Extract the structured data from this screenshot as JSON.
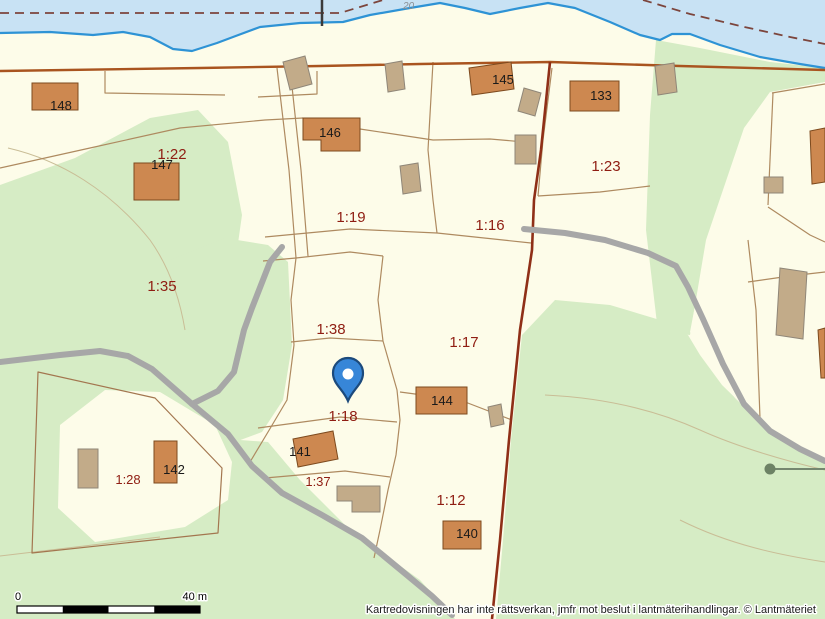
{
  "map": {
    "attribution": "Kartredovisningen har inte rättsverkan, jmfr mot beslut i lantmäterihandlingar. © Lantmäteriet",
    "depth_label": "20",
    "scale_bar": {
      "start": "0",
      "end": "40 m"
    },
    "marker": {
      "name": "location-pin"
    },
    "parcel_labels": [
      {
        "id": "1-22",
        "text": "1:22"
      },
      {
        "id": "1-23",
        "text": "1:23"
      },
      {
        "id": "1-19",
        "text": "1:19"
      },
      {
        "id": "1-16",
        "text": "1:16"
      },
      {
        "id": "1-35",
        "text": "1:35"
      },
      {
        "id": "1-38",
        "text": "1:38"
      },
      {
        "id": "1-17",
        "text": "1:17"
      },
      {
        "id": "1-18",
        "text": "1:18"
      },
      {
        "id": "1-28",
        "text": "1:28"
      },
      {
        "id": "1-37",
        "text": "1:37"
      },
      {
        "id": "1-12",
        "text": "1:12"
      }
    ],
    "building_labels": [
      {
        "id": "148",
        "text": "148"
      },
      {
        "id": "147",
        "text": "147"
      },
      {
        "id": "146",
        "text": "146"
      },
      {
        "id": "145",
        "text": "145"
      },
      {
        "id": "133",
        "text": "133"
      },
      {
        "id": "144",
        "text": "144"
      },
      {
        "id": "141",
        "text": "141"
      },
      {
        "id": "142",
        "text": "142"
      },
      {
        "id": "140",
        "text": "140"
      }
    ],
    "colors": {
      "water": "#c8e2f4",
      "shoreline": "#2e93d5",
      "land": "#fdfce9",
      "forest": "#d6ecc5",
      "road": "#a7a7a7",
      "building": "#cd8850",
      "building_secondary": "#c2ab89",
      "boundary_thick": "#8f2f17",
      "boundary_road": "#a9541f",
      "parcel_line": "#ae8a60",
      "parcel_label": "#8f1d12",
      "marker_blue": "#3786d8"
    }
  }
}
